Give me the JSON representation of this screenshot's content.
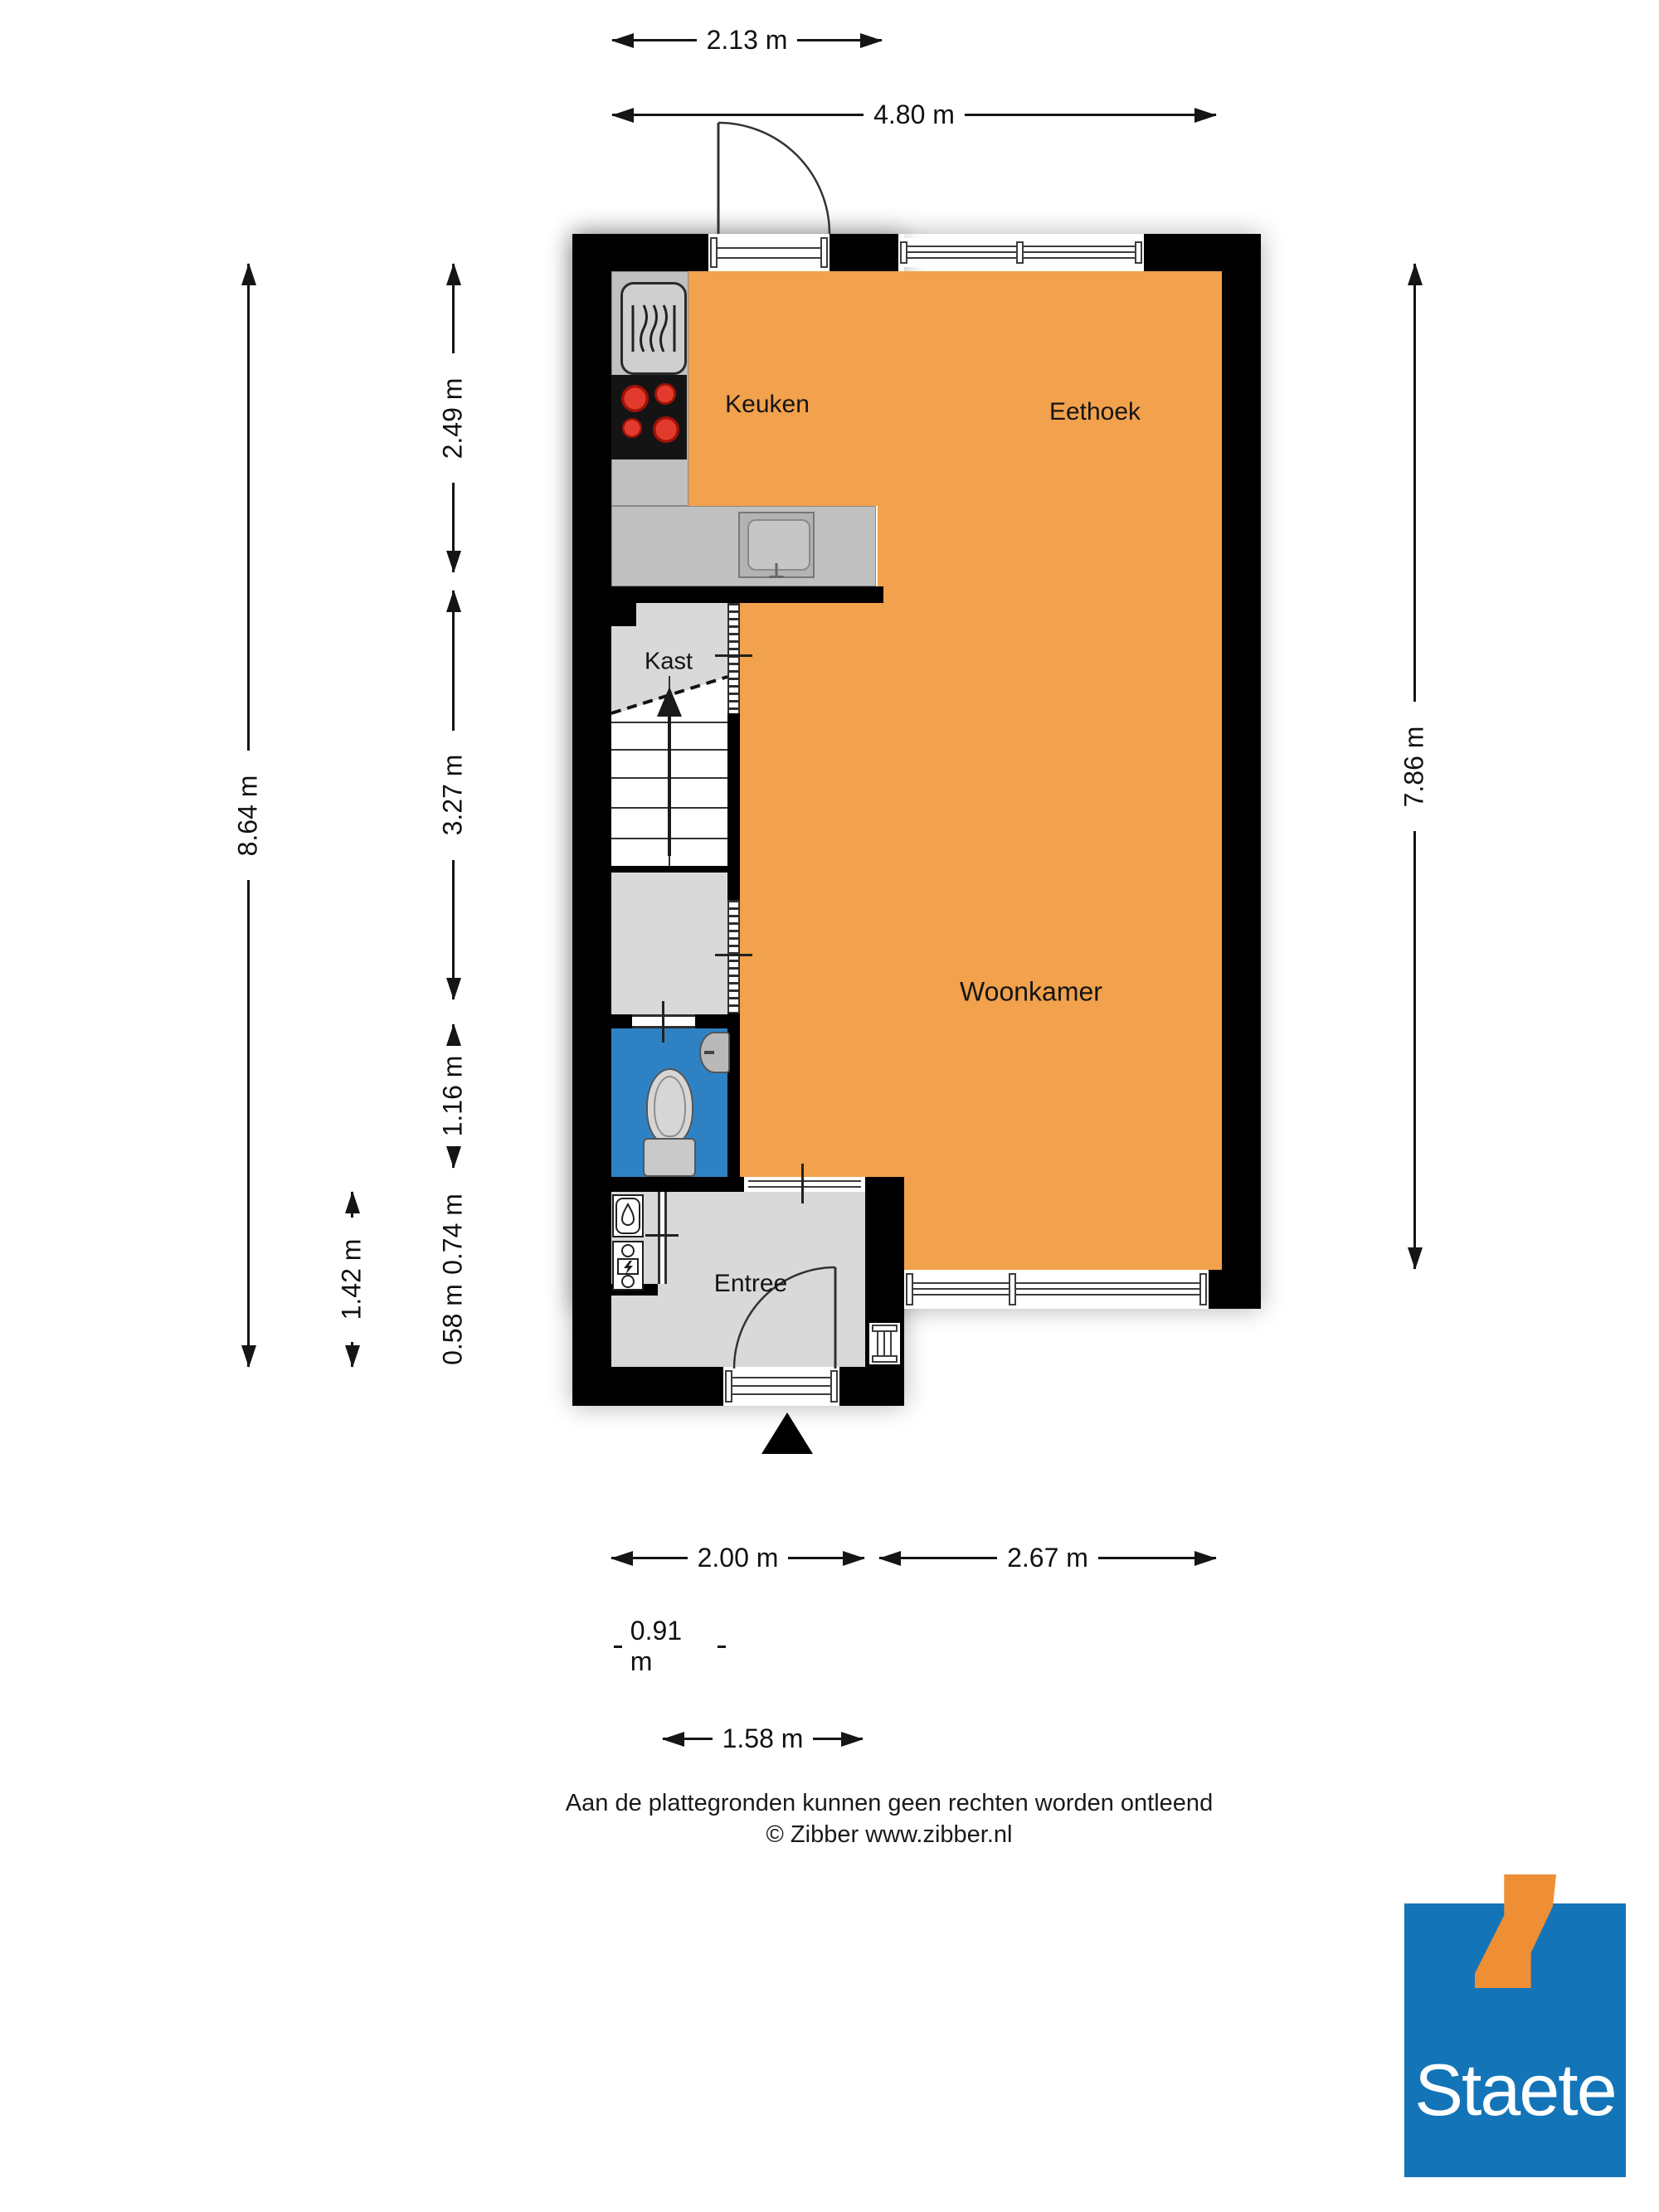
{
  "plan": {
    "rooms": {
      "keuken": "Keuken",
      "eethoek": "Eethoek",
      "woonkamer": "Woonkamer",
      "kast": "Kast",
      "entree": "Entree"
    }
  },
  "dimensions": {
    "t1": "2.13 m",
    "t2": "4.80 m",
    "l_outer": "8.64 m",
    "l1": "2.49 m",
    "l2": "3.27 m",
    "l3": "1.16 m",
    "l4": "0.74 m",
    "l5": "0.58 m",
    "l6": "1.42 m",
    "r1": "7.86 m",
    "b1": "2.00 m",
    "b2": "2.67 m",
    "b3": "0.91 m",
    "b4": "1.58 m"
  },
  "footer": {
    "disclaimer": "Aan de plattegronden kunnen geen rechten worden ontleend",
    "copyright": "© Zibber www.zibber.nl"
  },
  "logo": {
    "brand": "Staete"
  },
  "colors": {
    "wall": "#000000",
    "living": "#f2a14c",
    "toilet_floor": "#2e82c4",
    "counter": "#c0c0c0",
    "floor": "#d9d9d9",
    "stairs": "#ffffff",
    "logo_blue": "#1474b8",
    "logo_orange": "#ee8f35"
  }
}
